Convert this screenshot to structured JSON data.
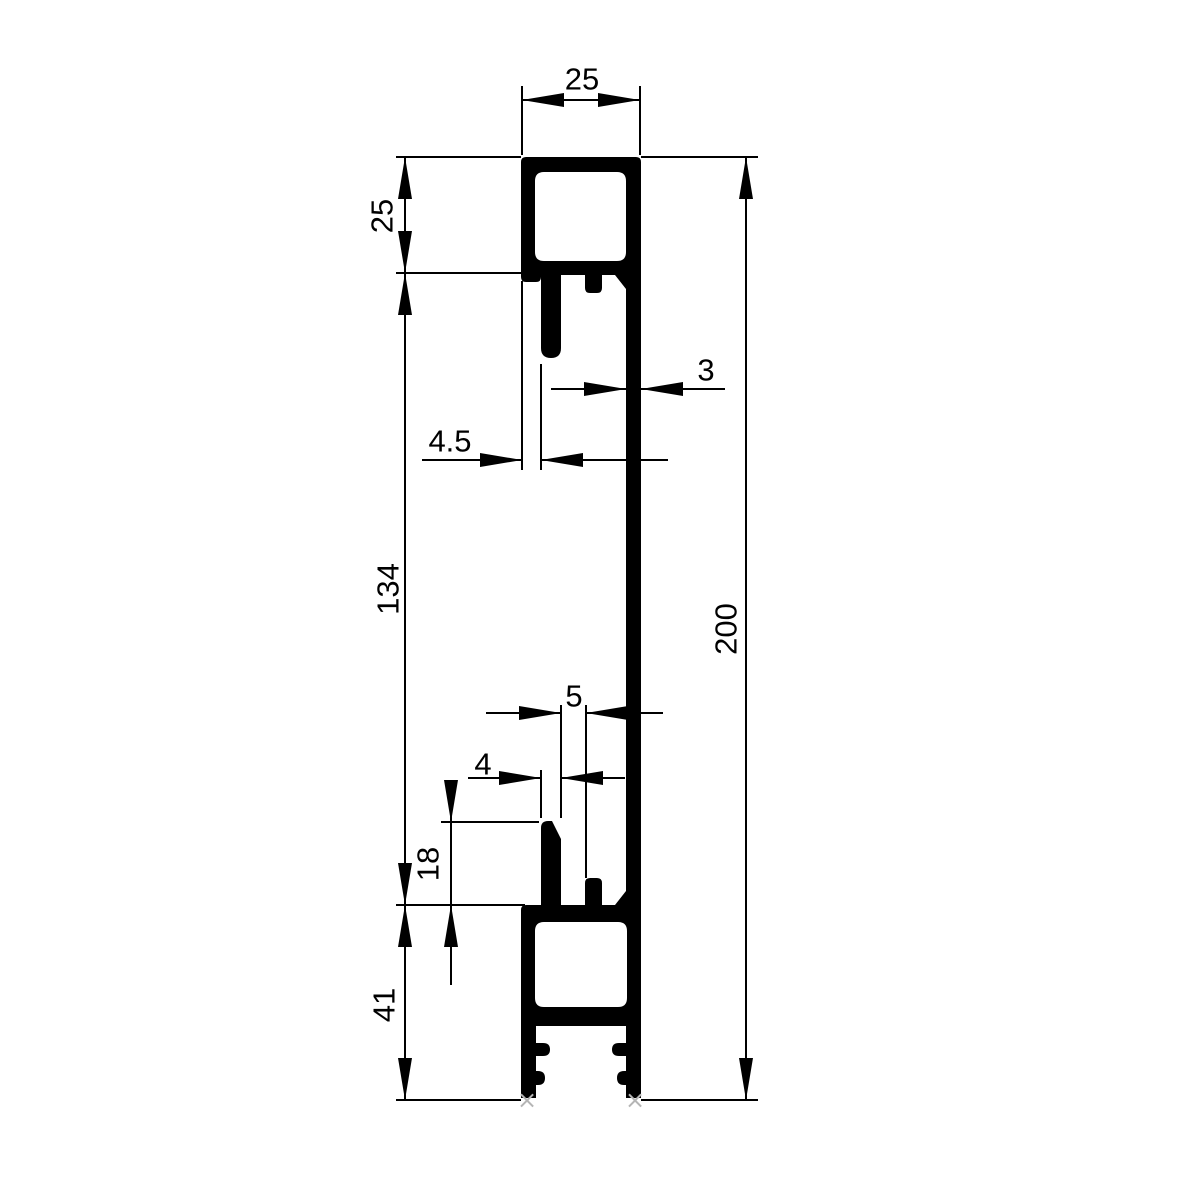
{
  "drawing": {
    "type": "aluminum-profile-cross-section",
    "background": "#ffffff",
    "ink_color": "#000000",
    "marker_color": "#b5b5b5",
    "foot_marker": "×",
    "labels": {
      "top_width": "25",
      "top_box_height": "25",
      "middle_height": "134",
      "bottom_height": "41",
      "bottom_prong_height": "18",
      "total_height": "200",
      "web_thickness": "3",
      "top_prong_offset": "4.5",
      "bottom_slot_width": "5",
      "bottom_prong_width": "4"
    }
  }
}
